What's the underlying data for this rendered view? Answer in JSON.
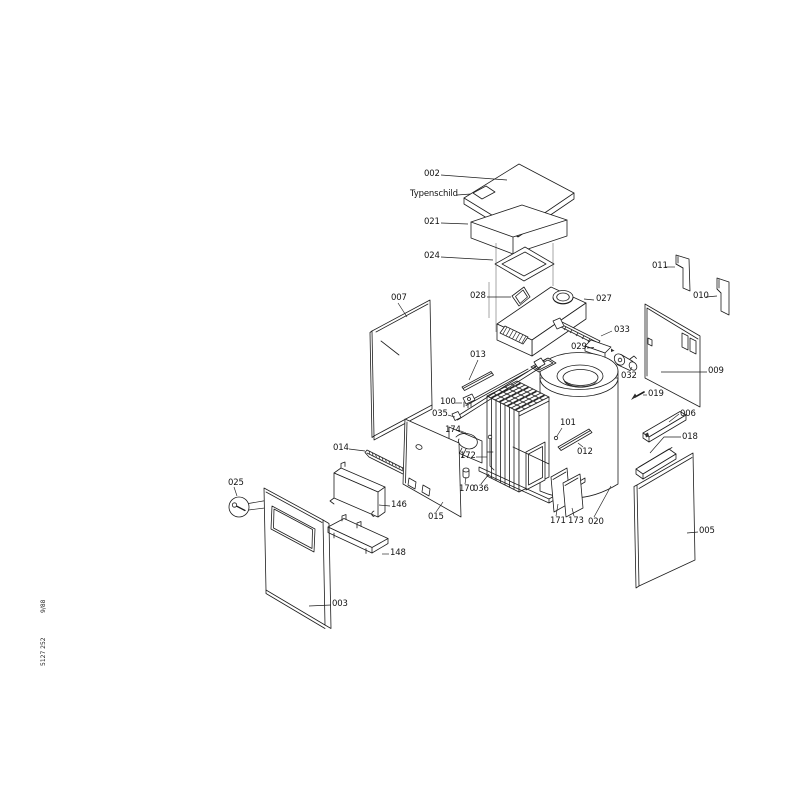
{
  "figure": {
    "type": "exploded-parts-diagram",
    "background": "#ffffff",
    "line_color": "#1d1d1d"
  },
  "doc_numbers": {
    "code": "5127 252",
    "date": "9/88"
  },
  "parts": [
    {
      "id": "002"
    },
    {
      "id": "Typenschild"
    },
    {
      "id": "021"
    },
    {
      "id": "024"
    },
    {
      "id": "028"
    },
    {
      "id": "027"
    },
    {
      "id": "033"
    },
    {
      "id": "029"
    },
    {
      "id": "032"
    },
    {
      "id": "013"
    },
    {
      "id": "100"
    },
    {
      "id": "035"
    },
    {
      "id": "174"
    },
    {
      "id": "172"
    },
    {
      "id": "170"
    },
    {
      "id": "036"
    },
    {
      "id": "171"
    },
    {
      "id": "173"
    },
    {
      "id": "020"
    },
    {
      "id": "101"
    },
    {
      "id": "012"
    },
    {
      "id": "019"
    },
    {
      "id": "006"
    },
    {
      "id": "018"
    },
    {
      "id": "005"
    },
    {
      "id": "009"
    },
    {
      "id": "010"
    },
    {
      "id": "011"
    },
    {
      "id": "007"
    },
    {
      "id": "014"
    },
    {
      "id": "146"
    },
    {
      "id": "148"
    },
    {
      "id": "015"
    },
    {
      "id": "025"
    },
    {
      "id": "003"
    }
  ]
}
